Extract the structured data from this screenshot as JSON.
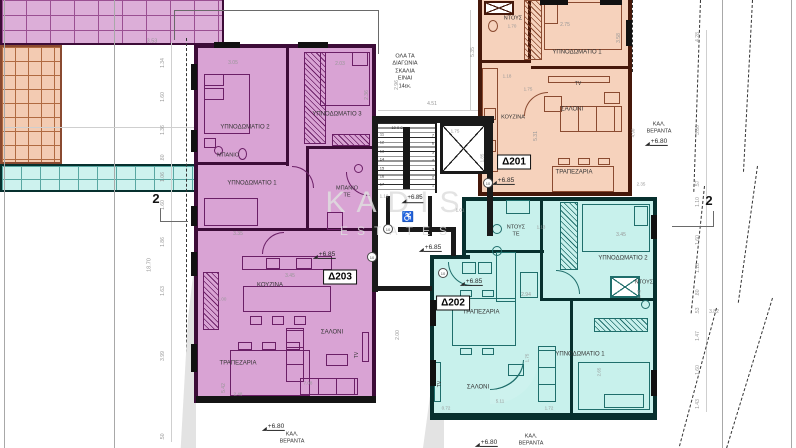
{
  "watermark": {
    "line1": "KADIS",
    "line2": "ESTATES"
  },
  "apartments": [
    {
      "id": "D201",
      "label": "Δ201",
      "fill": "#f6d2bc",
      "wall": "#46180a"
    },
    {
      "id": "D202",
      "label": "Δ202",
      "fill": "#c8f1ec",
      "wall": "#07302e"
    },
    {
      "id": "D203",
      "label": "Δ9a3d4",
      "wall": "#3d0c38"
    }
  ],
  "labels": [
    {
      "n": "room-label-d203-bedroom2",
      "cls": "room",
      "t": "ΥΠΝΟΔΩΜΑΤΙΟ 2",
      "x": 245,
      "y": 128,
      "s": 6
    },
    {
      "n": "room-label-d203-bedroom3",
      "cls": "room",
      "t": "ΥΠΝΟΔΩΜΑΤΙΟ 3",
      "x": 337,
      "y": 115,
      "s": 6
    },
    {
      "n": "room-label-d203-bath",
      "cls": "room",
      "t": "ΜΠΑΝΙΟ",
      "x": 228,
      "y": 156,
      "s": 5.5
    },
    {
      "n": "room-label-d203-bedroom1",
      "cls": "room",
      "t": "ΥΠΝΟΔΩΜΑΤΙΟ 1",
      "x": 252,
      "y": 184,
      "s": 6
    },
    {
      "n": "room-label-d203-bath-te",
      "cls": "room",
      "t": "ΜΠΑΝΙΟ\nΤΕ",
      "x": 347,
      "y": 192,
      "s": 5.5
    },
    {
      "n": "room-label-d203-kitchen",
      "cls": "room",
      "t": "ΚΟΥΖΙΝΑ",
      "x": 270,
      "y": 286,
      "s": 6
    },
    {
      "n": "room-label-d203-living",
      "cls": "room",
      "t": "ΣΑΛΟΝΙ",
      "x": 332,
      "y": 333,
      "s": 6
    },
    {
      "n": "room-label-d203-dining",
      "cls": "room",
      "t": "ΤΡΑΠΕΖΑΡΙΑ",
      "x": 238,
      "y": 364,
      "s": 6
    },
    {
      "n": "room-label-d203-tv",
      "cls": "room",
      "t": "TV",
      "x": 357,
      "y": 355,
      "s": 5,
      "r": -90
    },
    {
      "n": "room-label-d203-veranda",
      "cls": "room",
      "t": "ΚΑΛ.\nΒΕΡΑΝΤΑ",
      "x": 292,
      "y": 438,
      "s": 5.5
    },
    {
      "n": "elevation-d203",
      "cls": "elev",
      "t": "+6.85",
      "x": 327,
      "y": 255,
      "s": 6.5
    },
    {
      "n": "elevation-d203-veranda",
      "cls": "elev",
      "t": "+6.80",
      "x": 276,
      "y": 427,
      "s": 6.5
    },
    {
      "n": "unit-label-d203",
      "cls": "unit",
      "t": "Δ203",
      "x": 340,
      "y": 277,
      "s": 10
    },
    {
      "n": "room-label-d201-shower",
      "cls": "room",
      "t": "ΝΤΟΥΣ",
      "x": 513,
      "y": 19,
      "s": 5.5
    },
    {
      "n": "room-label-d201-bedroom1",
      "cls": "room",
      "t": "ΥΠΝΟΔΩΜΑΤΙΟ 1",
      "x": 577,
      "y": 53,
      "s": 6
    },
    {
      "n": "room-label-d201-tv",
      "cls": "room",
      "t": "TV",
      "x": 578,
      "y": 84,
      "s": 5
    },
    {
      "n": "room-label-d201-living",
      "cls": "room",
      "t": "ΣΑΛΟΝΙ",
      "x": 572,
      "y": 110,
      "s": 6
    },
    {
      "n": "room-label-d201-kitchen",
      "cls": "room",
      "t": "ΚΟΥΖΙΝΑ",
      "x": 513,
      "y": 118,
      "s": 5.5
    },
    {
      "n": "room-label-d201-dining",
      "cls": "room",
      "t": "ΤΡΑΠΕΖΑΡΙΑ",
      "x": 574,
      "y": 173,
      "s": 6
    },
    {
      "n": "room-label-d201-veranda",
      "cls": "room",
      "t": "ΚΑΛ.\nΒΕΡΑΝΤΑ",
      "x": 659,
      "y": 128,
      "s": 5.5
    },
    {
      "n": "elevation-d201-veranda",
      "cls": "elev",
      "t": "+6.80",
      "x": 659,
      "y": 142,
      "s": 6.5
    },
    {
      "n": "elevation-d201",
      "cls": "elev",
      "t": "+6.85",
      "x": 506,
      "y": 181,
      "s": 6.5
    },
    {
      "n": "unit-label-d201",
      "cls": "unit",
      "t": "Δ201",
      "x": 514,
      "y": 162,
      "s": 10
    },
    {
      "n": "room-label-d202-shower-te",
      "cls": "room",
      "t": "ΝΤΟΥΣ\nΤΕ",
      "x": 516,
      "y": 231,
      "s": 5.5
    },
    {
      "n": "room-label-d202-bedroom2",
      "cls": "room",
      "t": "ΥΠΝΟΔΩΜΑΤΙΟ 2",
      "x": 623,
      "y": 259,
      "s": 6
    },
    {
      "n": "room-label-d202-shower",
      "cls": "room",
      "t": "ΝΤΟΥΣ",
      "x": 644,
      "y": 283,
      "s": 5.5
    },
    {
      "n": "room-label-d202-dining",
      "cls": "room",
      "t": "ΤΡΑΠΕΖΑΡΙΑ",
      "x": 481,
      "y": 313,
      "s": 6
    },
    {
      "n": "room-label-d202-living",
      "cls": "room",
      "t": "ΣΑΛΟΝΙ",
      "x": 478,
      "y": 388,
      "s": 6
    },
    {
      "n": "room-label-d202-tv",
      "cls": "room",
      "t": "TV",
      "x": 440,
      "y": 384,
      "s": 5,
      "r": -90
    },
    {
      "n": "room-label-d202-bedroom1",
      "cls": "room",
      "t": "ΥΠΝΟΔΩΜΑΤΙΟ 1",
      "x": 580,
      "y": 355,
      "s": 6
    },
    {
      "n": "room-label-d202-veranda",
      "cls": "room",
      "t": "ΚΑΛ.\nΒΕΡΑΝΤΑ",
      "x": 531,
      "y": 440,
      "s": 5.5
    },
    {
      "n": "elevation-d202-veranda",
      "cls": "elev",
      "t": "+6.80",
      "x": 489,
      "y": 443,
      "s": 6.5
    },
    {
      "n": "elevation-d202",
      "cls": "elev",
      "t": "+6.85",
      "x": 474,
      "y": 282,
      "s": 6.5
    },
    {
      "n": "unit-label-d202",
      "cls": "unit",
      "t": "Δ202",
      "x": 453,
      "y": 303,
      "s": 10
    },
    {
      "n": "stair-note",
      "cls": "note",
      "t": "ΟΛΑ ΤΑ\nΔΙΑΓΩΝΙΑ\nΣΚΑΛΙΑ\nΕΙΝΑΙ\n14εκ.",
      "x": 405,
      "y": 72,
      "s": 5.5
    },
    {
      "n": "wheelchair-symbol",
      "cls": "wheel",
      "t": "♿",
      "x": 408,
      "y": 218,
      "s": 10
    },
    {
      "n": "elevation-lobby",
      "cls": "elev",
      "t": "+6.85",
      "x": 433,
      "y": 248,
      "s": 6.5
    },
    {
      "n": "elevation-stair-base",
      "cls": "elev",
      "t": "+6.85",
      "x": 415,
      "y": 199,
      "s": 6
    },
    {
      "n": "stair-numbers-top",
      "cls": "stairnum",
      "t": "10 9 8",
      "x": 397,
      "y": 128,
      "s": 4
    },
    {
      "n": "stair-numbers-left",
      "cls": "stairnum",
      "t": "11\n12\n13\n14\n15\n16\n17",
      "x": 382,
      "y": 160,
      "s": 4
    },
    {
      "n": "stair-numbers-right",
      "cls": "stairnum",
      "t": "7\n6\n5\n4\n3\n2\n1",
      "x": 433,
      "y": 161,
      "s": 4
    },
    {
      "n": "dim-3-05",
      "cls": "dim",
      "t": "3.05",
      "x": 233,
      "y": 63,
      "s": 5
    },
    {
      "n": "dim-2-03",
      "cls": "dim",
      "t": "2.03",
      "x": 340,
      "y": 64,
      "s": 5
    },
    {
      "n": "dim-2-36",
      "cls": "dim",
      "t": "2.36",
      "x": 367,
      "y": 95,
      "s": 5,
      "r": -90
    },
    {
      "n": "dim-3-35",
      "cls": "dim",
      "t": "3.35",
      "x": 238,
      "y": 234,
      "s": 5
    },
    {
      "n": "dim-3-45-m",
      "cls": "dim",
      "t": "3.45",
      "x": 290,
      "y": 276,
      "s": 5
    },
    {
      "n": "dim-1-00",
      "cls": "dim",
      "t": "1.00",
      "x": 222,
      "y": 299,
      "s": 4.5
    },
    {
      "n": "dim-5-42",
      "cls": "dim",
      "t": "5.42",
      "x": 224,
      "y": 388,
      "s": 5,
      "r": -90
    },
    {
      "n": "dim-2-48",
      "cls": "dim",
      "t": "2.48",
      "x": 238,
      "y": 394,
      "s": 4.5
    },
    {
      "n": "dim-7-08",
      "cls": "dim",
      "t": "7.08",
      "x": 308,
      "y": 383,
      "s": 4.5
    },
    {
      "n": "dim-4-51",
      "cls": "dim",
      "t": "4.51",
      "x": 432,
      "y": 104,
      "s": 5
    },
    {
      "n": "dim-1-75-core",
      "cls": "dim",
      "t": "1.75",
      "x": 455,
      "y": 131,
      "s": 4.5
    },
    {
      "n": "dim-1-85-core",
      "cls": "dim",
      "t": "1.85",
      "x": 482,
      "y": 158,
      "s": 4.5,
      "r": -90
    },
    {
      "n": "dim-2-96",
      "cls": "dim",
      "t": "2.96",
      "x": 397,
      "y": 85,
      "s": 5,
      "r": -90
    },
    {
      "n": "dim-5-35",
      "cls": "dim",
      "t": "5.35",
      "x": 473,
      "y": 52,
      "s": 5,
      "r": -90
    },
    {
      "n": "dim-2-00",
      "cls": "dim",
      "t": "2.00",
      "x": 398,
      "y": 335,
      "s": 5,
      "r": -90
    },
    {
      "n": "dim-1-10-a",
      "cls": "dim",
      "t": "1.10",
      "x": 384,
      "y": 196,
      "s": 4.5
    },
    {
      "n": "dim-1-10-b",
      "cls": "dim",
      "t": "1.10",
      "x": 417,
      "y": 196,
      "s": 4.5
    },
    {
      "n": "dim-1-01",
      "cls": "dim",
      "t": "1.01",
      "x": 460,
      "y": 210,
      "s": 4.5
    },
    {
      "n": "dim-1-70",
      "cls": "dim",
      "t": "1.70",
      "x": 512,
      "y": 26,
      "s": 4.5
    },
    {
      "n": "dim-2-75",
      "cls": "dim",
      "t": "2.75",
      "x": 565,
      "y": 25,
      "s": 5
    },
    {
      "n": "dim-3-58",
      "cls": "dim",
      "t": "3.58",
      "x": 619,
      "y": 38,
      "s": 5,
      "r": -90
    },
    {
      "n": "dim-1-18-o",
      "cls": "dim",
      "t": "1.18",
      "x": 507,
      "y": 76,
      "s": 4.5
    },
    {
      "n": "dim-1-75-o",
      "cls": "dim",
      "t": "1.75",
      "x": 528,
      "y": 89,
      "s": 4.5
    },
    {
      "n": "dim-5-31",
      "cls": "dim",
      "t": "5.31",
      "x": 536,
      "y": 136,
      "s": 5,
      "r": -90
    },
    {
      "n": "dim-4-90",
      "cls": "dim",
      "t": "4.90",
      "x": 633,
      "y": 133,
      "s": 4.5,
      "r": -90
    },
    {
      "n": "dim-2-35",
      "cls": "dim",
      "t": "2.35",
      "x": 641,
      "y": 184,
      "s": 4.5
    },
    {
      "n": "dim-1-13",
      "cls": "dim",
      "t": "1.13",
      "x": 541,
      "y": 227,
      "s": 4.5
    },
    {
      "n": "dim-3-45-c",
      "cls": "dim",
      "t": "3.45",
      "x": 621,
      "y": 235,
      "s": 5
    },
    {
      "n": "dim-2-94",
      "cls": "dim",
      "t": "2.94",
      "x": 526,
      "y": 295,
      "s": 5
    },
    {
      "n": "dim-1-45",
      "cls": "dim",
      "t": "1.45",
      "x": 639,
      "y": 294,
      "s": 4.5,
      "r": -90
    },
    {
      "n": "dim-1-75-c",
      "cls": "dim",
      "t": "1.75",
      "x": 527,
      "y": 358,
      "s": 4.5,
      "r": -90
    },
    {
      "n": "dim-2-65",
      "cls": "dim",
      "t": "2.65",
      "x": 599,
      "y": 372,
      "s": 4.5,
      "r": -90
    },
    {
      "n": "dim-5-11",
      "cls": "dim",
      "t": "5.11",
      "x": 500,
      "y": 401,
      "s": 4.5
    },
    {
      "n": "dim-0-72",
      "cls": "dim",
      "t": "0.72",
      "x": 446,
      "y": 408,
      "s": 4.5
    },
    {
      "n": "dim-1-72",
      "cls": "dim",
      "t": "1.72",
      "x": 549,
      "y": 408,
      "s": 4.5
    },
    {
      "n": "dim-3-53",
      "cls": "dim",
      "t": "3.53",
      "x": 152,
      "y": 42,
      "s": 5.5
    },
    {
      "n": "dim-left-1-34",
      "cls": "dim",
      "t": "1.34",
      "x": 163,
      "y": 63,
      "s": 5,
      "r": -90
    },
    {
      "n": "dim-left-1-60a",
      "cls": "dim",
      "t": "1.60",
      "x": 163,
      "y": 97,
      "s": 5,
      "r": -90
    },
    {
      "n": "dim-left-1-36",
      "cls": "dim",
      "t": "1.36",
      "x": 163,
      "y": 130,
      "s": 5,
      "r": -90
    },
    {
      "n": "dim-left-80",
      "cls": "dim",
      "t": ".80",
      "x": 163,
      "y": 158,
      "s": 5,
      "r": -90
    },
    {
      "n": "dim-left-1-06",
      "cls": "dim",
      "t": "1.06",
      "x": 163,
      "y": 177,
      "s": 5,
      "r": -90
    },
    {
      "n": "dim-left-1-60b",
      "cls": "dim",
      "t": "1.60",
      "x": 163,
      "y": 205,
      "s": 5,
      "r": -90
    },
    {
      "n": "dim-left-1-86",
      "cls": "dim",
      "t": "1.86",
      "x": 163,
      "y": 242,
      "s": 5,
      "r": -90
    },
    {
      "n": "dim-left-1-63",
      "cls": "dim",
      "t": "1.63",
      "x": 163,
      "y": 291,
      "s": 5,
      "r": -90
    },
    {
      "n": "dim-left-3-99",
      "cls": "dim",
      "t": "3.99",
      "x": 163,
      "y": 356,
      "s": 5,
      "r": -90
    },
    {
      "n": "dim-left-50",
      "cls": "dim",
      "t": ".50",
      "x": 163,
      "y": 437,
      "s": 5,
      "r": -90
    },
    {
      "n": "dim-left-18-70",
      "cls": "dim",
      "t": "18.70",
      "x": 150,
      "y": 265,
      "s": 5.5,
      "r": -90
    },
    {
      "n": "section-marker-left",
      "cls": "section",
      "t": "2",
      "x": 156,
      "y": 199,
      "s": 13
    },
    {
      "n": "dim-right-4-28",
      "cls": "dim",
      "t": "4.28",
      "x": 698,
      "y": 37,
      "s": 5,
      "r": -90
    },
    {
      "n": "dim-right-3-80",
      "cls": "dim",
      "t": "3.80",
      "x": 698,
      "y": 130,
      "s": 5,
      "r": -90
    },
    {
      "n": "dim-right-57",
      "cls": "dim",
      "t": ".57",
      "x": 698,
      "y": 184,
      "s": 5,
      "r": -90
    },
    {
      "n": "dim-right-1-10",
      "cls": "dim",
      "t": "1.10",
      "x": 698,
      "y": 202,
      "s": 5,
      "r": -90
    },
    {
      "n": "dim-right-1-60a",
      "cls": "dim",
      "t": "1.60",
      "x": 698,
      "y": 240,
      "s": 5,
      "r": -90
    },
    {
      "n": "dim-right-1-18",
      "cls": "dim",
      "t": "1.18",
      "x": 698,
      "y": 268,
      "s": 5,
      "r": -90
    },
    {
      "n": "dim-right-80",
      "cls": "dim",
      "t": ".80",
      "x": 698,
      "y": 293,
      "s": 5,
      "r": -90
    },
    {
      "n": "dim-right-53",
      "cls": "dim",
      "t": ".53",
      "x": 698,
      "y": 311,
      "s": 5,
      "r": -90
    },
    {
      "n": "dim-right-1-47",
      "cls": "dim",
      "t": "1.47",
      "x": 698,
      "y": 336,
      "s": 5,
      "r": -90
    },
    {
      "n": "dim-right-1-60b",
      "cls": "dim",
      "t": "1.60",
      "x": 698,
      "y": 370,
      "s": 5,
      "r": -90
    },
    {
      "n": "dim-right-1-43",
      "cls": "dim",
      "t": "1.43",
      "x": 698,
      "y": 404,
      "s": 5,
      "r": -90
    },
    {
      "n": "dim-right-3-82",
      "cls": "dim",
      "t": "3.82",
      "x": 714,
      "y": 312,
      "s": 5
    },
    {
      "n": "section-marker-right",
      "cls": "section",
      "t": "2",
      "x": 709,
      "y": 201,
      "s": 13
    },
    {
      "n": "keynote-10-a",
      "cls": "keynote",
      "t": "10",
      "x": 388,
      "y": 229,
      "s": 4
    },
    {
      "n": "keynote-10-b",
      "cls": "keynote",
      "t": "10",
      "x": 443,
      "y": 273,
      "s": 4
    },
    {
      "n": "keynote-10-c",
      "cls": "keynote",
      "t": "10",
      "x": 488,
      "y": 183,
      "s": 4
    },
    {
      "n": "keynote-10-d",
      "cls": "keynote",
      "t": "10",
      "x": 372,
      "y": 257,
      "s": 4
    }
  ]
}
